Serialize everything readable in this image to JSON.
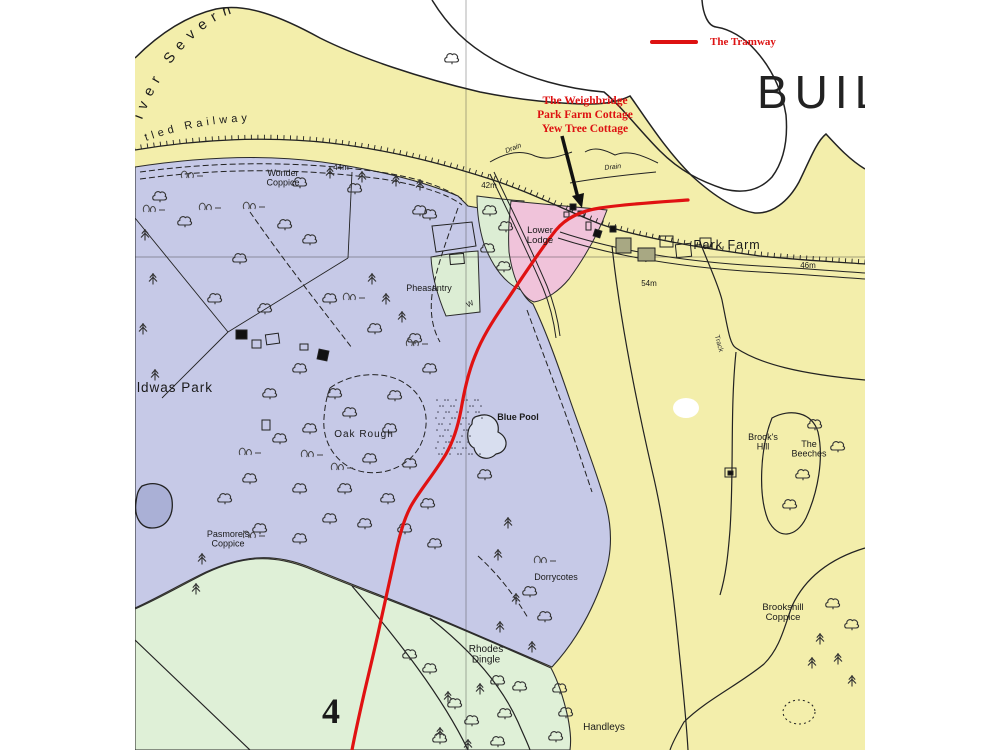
{
  "map": {
    "description": "Scanned map extract showing the tramway route near Buildwas, River Severn",
    "colors": {
      "field_yellow": "#f3eeab",
      "parkland_purple": "#c6c9e7",
      "meadow_green": "#dff0d7",
      "patch_green": "#dcedd4",
      "lodge_pink": "#f0c3da",
      "river_white": "#ffffff",
      "tramway_red": "#e01212",
      "annotation_red": "#dd1111",
      "line_black": "#222222",
      "pool_blue": "#d8deef"
    },
    "river_label": "iver Severn",
    "railway_label": "tled Railway",
    "legend": {
      "tramway_label": "The Tramway"
    },
    "annotation": {
      "lines": [
        "The Weighbridge",
        "Park Farm Cottage",
        "Yew Tree Cottage"
      ]
    },
    "symbols": {
      "broadleaf_tree": "broadleaf-tree-icon",
      "conifer_tree": "conifer-tree-icon",
      "grass_tuft": "grass-tuft-icon"
    },
    "labels": [
      {
        "id": "legend-tramway",
        "text": "The Tramway",
        "x": 710,
        "y": 45,
        "size": 11,
        "color": "#dd1111",
        "family": "serif",
        "weight": 700,
        "anchor": "start"
      },
      {
        "id": "annotation-line-1",
        "text": "The Weighbridge",
        "x": 585,
        "y": 104,
        "size": 11.5,
        "color": "#dd1111",
        "family": "serif",
        "weight": 700
      },
      {
        "id": "annotation-line-2",
        "text": "Park Farm Cottage",
        "x": 585,
        "y": 118,
        "size": 11.5,
        "color": "#dd1111",
        "family": "serif",
        "weight": 700
      },
      {
        "id": "annotation-line-3",
        "text": "Yew Tree Cottage",
        "x": 585,
        "y": 132,
        "size": 11.5,
        "color": "#dd1111",
        "family": "serif",
        "weight": 700
      },
      {
        "id": "buildwas-big",
        "text": "BUIL",
        "x": 757,
        "y": 108,
        "size": 46,
        "weight": 400,
        "ls": 7,
        "anchor": "start",
        "color": "#222222"
      },
      {
        "id": "wonder-coppice",
        "lines": [
          "Wonder",
          "Coppice"
        ],
        "x": 283,
        "y": 176,
        "size": 9
      },
      {
        "id": "spot-height-44m",
        "text": "44m",
        "x": 341,
        "y": 170,
        "size": 8
      },
      {
        "id": "spot-height-42m",
        "text": "42m",
        "x": 489,
        "y": 188,
        "size": 8
      },
      {
        "id": "drain-1",
        "text": "Drain",
        "x": 514,
        "y": 150,
        "size": 7,
        "rot": -22,
        "style": "italic"
      },
      {
        "id": "drain-2",
        "text": "Drain",
        "x": 613,
        "y": 169,
        "size": 7,
        "rot": -6,
        "style": "italic"
      },
      {
        "id": "lower-lodge",
        "lines": [
          "Lower",
          "Lodge"
        ],
        "x": 540,
        "y": 233,
        "size": 9.5
      },
      {
        "id": "park-farm",
        "text": "Park Farm",
        "x": 727,
        "y": 249,
        "size": 12.5,
        "ls": 1
      },
      {
        "id": "spot-height-54m",
        "text": "54m",
        "x": 649,
        "y": 286,
        "size": 8
      },
      {
        "id": "spot-height-46m",
        "text": "46m",
        "x": 808,
        "y": 268,
        "size": 8
      },
      {
        "id": "pheasantry",
        "text": "Pheasantry",
        "x": 429,
        "y": 291,
        "size": 9
      },
      {
        "id": "well-w",
        "text": "W",
        "x": 471,
        "y": 306,
        "size": 7.5,
        "rot": -25
      },
      {
        "id": "buildwas-park",
        "text": "ldwas Park",
        "x": 137,
        "y": 392,
        "size": 13.5,
        "anchor": "start",
        "ls": 1
      },
      {
        "id": "oak-rough",
        "text": "Oak Rough",
        "x": 364,
        "y": 437,
        "size": 10,
        "ls": 1
      },
      {
        "id": "blue-pool",
        "text": "Blue Pool",
        "x": 518,
        "y": 420,
        "size": 9,
        "weight": 700
      },
      {
        "id": "brooks-hill",
        "lines": [
          "Brook's",
          "Hill"
        ],
        "x": 763,
        "y": 440,
        "size": 9
      },
      {
        "id": "the-beeches",
        "lines": [
          "The",
          "Beeches"
        ],
        "x": 809,
        "y": 447,
        "size": 9
      },
      {
        "id": "pasmores-coppice",
        "lines": [
          "Pasmore's",
          "Coppice"
        ],
        "x": 228,
        "y": 537,
        "size": 9
      },
      {
        "id": "dorrycotes",
        "text": "Dorrycotes",
        "x": 556,
        "y": 580,
        "size": 9
      },
      {
        "id": "brookshill-coppice",
        "lines": [
          "Brookshill",
          "Coppice"
        ],
        "x": 783,
        "y": 610,
        "size": 9.5
      },
      {
        "id": "rhodes-dingle",
        "lines": [
          "Rhodes",
          "Dingle"
        ],
        "x": 486,
        "y": 652,
        "size": 10
      },
      {
        "id": "handleys",
        "text": "Handleys",
        "x": 604,
        "y": 730,
        "size": 10
      },
      {
        "id": "grid-number-4",
        "text": "4",
        "x": 331,
        "y": 723,
        "size": 36,
        "family": "serif",
        "weight": 700
      },
      {
        "id": "track",
        "text": "Track",
        "x": 717,
        "y": 344,
        "size": 7,
        "rot": 75,
        "color": "#333333"
      }
    ]
  }
}
